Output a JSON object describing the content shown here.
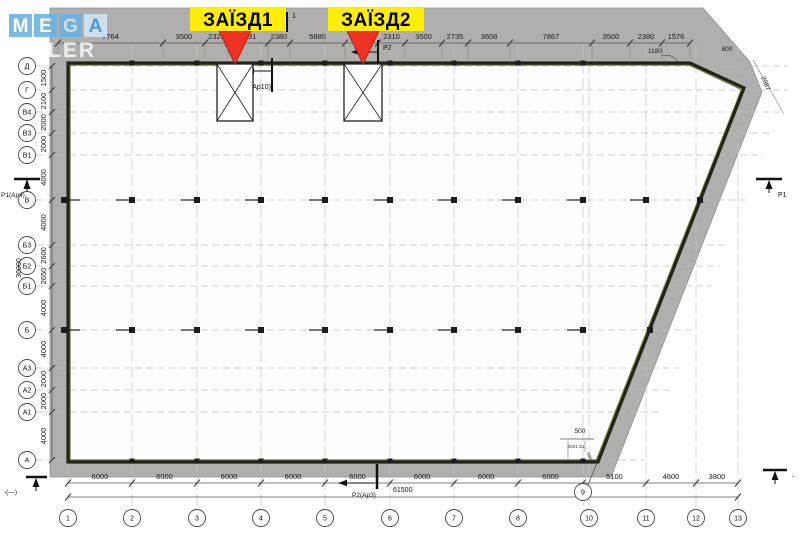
{
  "watermark": {
    "tiles": [
      "M",
      "E",
      "G",
      "A"
    ],
    "subtitle": "LER"
  },
  "entrances": [
    {
      "label": "ЗАЇЗД1"
    },
    {
      "label": "ЗАЇЗД2"
    }
  ],
  "axes": {
    "rows": [
      "Д",
      "Г",
      "В4",
      "В3",
      "В1",
      "В",
      "Б3",
      "Б2",
      "Б1",
      "Б",
      "А3",
      "А2",
      "А1",
      "А"
    ],
    "cols": [
      "1",
      "2",
      "3",
      "4",
      "5",
      "6",
      "7",
      "8",
      "9",
      "10",
      "11",
      "12",
      "13"
    ]
  },
  "dims": {
    "top": [
      "7764",
      "3500",
      "2329",
      "3591",
      "2380",
      "5880",
      "3510",
      "2310",
      "3500",
      "2735",
      "3608",
      "7867",
      "3500",
      "2380",
      "1576"
    ],
    "left": [
      "1500",
      "2100",
      "2000",
      "2000",
      "4000",
      "4000",
      "2600",
      "2650",
      "4000",
      "4000",
      "2000",
      "2000",
      "4000"
    ],
    "bottom": [
      "6000",
      "6000",
      "6000",
      "6000",
      "6000",
      "6000",
      "6000",
      "6000",
      "5100",
      "4600",
      "3800"
    ],
    "totals": {
      "bottom": "61500",
      "left": "36000"
    },
    "extra": {
      "e1180": "1180",
      "e800": "800",
      "e2087": "2087",
      "e500": "500",
      "eSmall": "2021.51",
      "e590": "590"
    }
  },
  "markers": {
    "section1": "1",
    "section1_ref": "1(Ap10)",
    "p2_top": "P2",
    "p1_left": "P1(Ap4)",
    "p1_right": "P1",
    "p2_bottom": "P2(Ap3)",
    "datum_left": "-(—)",
    "datum_right": "-"
  },
  "colors": {
    "band": "#b0afad",
    "wall": "#23251a",
    "wall_inner": "#6b742c",
    "accent_red": "#ee3122",
    "accent_yellow": "#ffee00",
    "watermark_blue": "#68b0e0",
    "watermark_light": "#d2e6f5"
  }
}
